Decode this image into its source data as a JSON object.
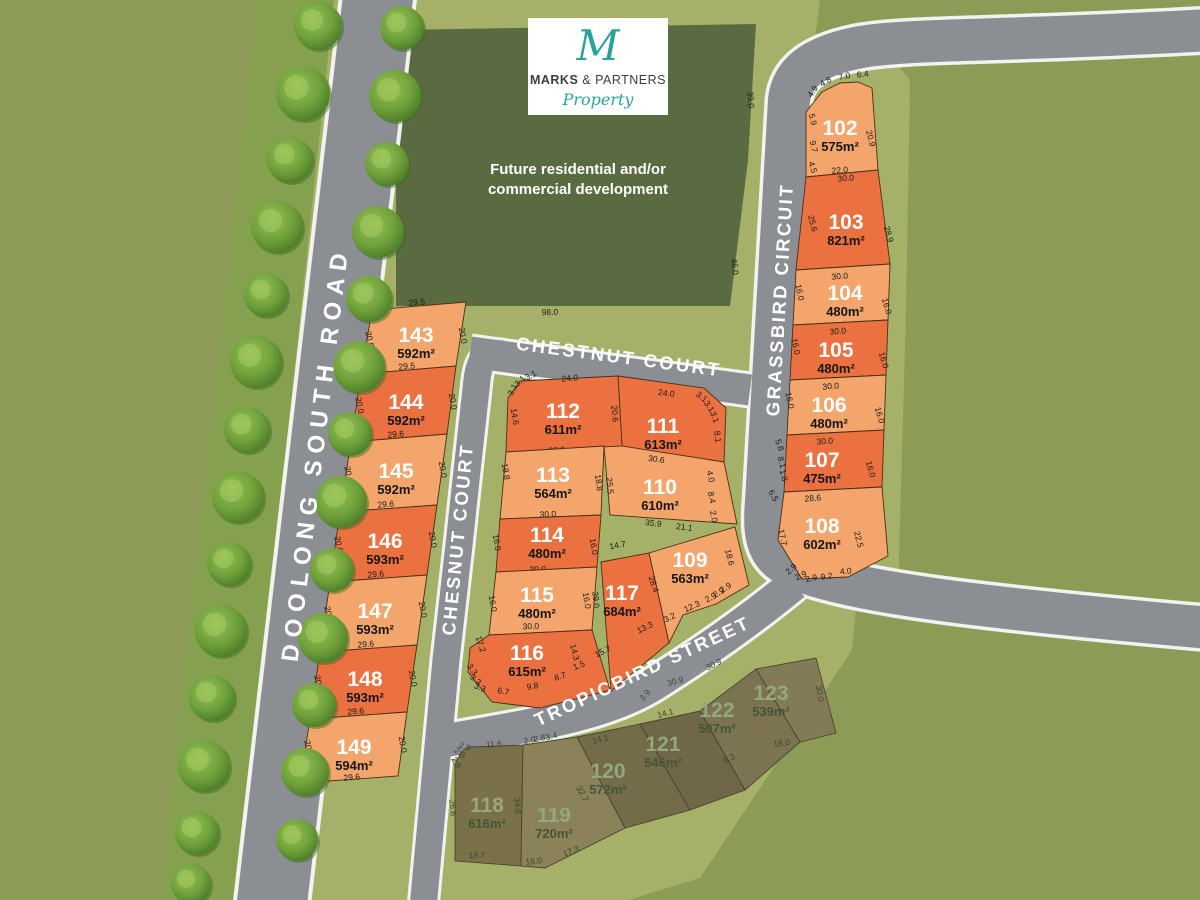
{
  "logo": {
    "initial": "M",
    "name_bold": "MARKS",
    "name_rest": " & PARTNERS",
    "tagline": "Property",
    "teal": "#2BA39B"
  },
  "future_block": {
    "label_line1": "Future residential and/or",
    "label_line2": "commercial development",
    "dims": [
      "75.0",
      "39.0",
      "46.0",
      "98.0"
    ]
  },
  "streets": {
    "doolong": "DOOLONG SOUTH ROAD",
    "chestnut": "CHESTNUT COURT",
    "chesnut": "CHESNUT COURT",
    "grassbird": "GRASSBIRD CIRCUIT",
    "tropicbird": "TROPICBIRD STREET"
  },
  "colors": {
    "lot_available_light": "#F4A56C",
    "lot_available_dark": "#EC7140",
    "lot_sold_base": "#7B7148",
    "road": "#8B8F94",
    "estate_green": "#A5B169",
    "olive_background": "#8C9C57",
    "future_block_green": "#5A6B41"
  },
  "lots": [
    {
      "number": "102",
      "area": "575m²",
      "status": "available",
      "dims": [
        "4.9",
        "4.8",
        "7.0",
        "6.4",
        "5.9",
        "9.7",
        "4.5",
        "20.9",
        "22.0"
      ]
    },
    {
      "number": "103",
      "area": "821m²",
      "status": "available",
      "dims": [
        "30.0",
        "25.6",
        "28.9"
      ]
    },
    {
      "number": "104",
      "area": "480m²",
      "status": "available",
      "dims": [
        "30.0",
        "16.0",
        "16.0"
      ]
    },
    {
      "number": "105",
      "area": "480m²",
      "status": "available",
      "dims": [
        "30.0",
        "16.0",
        "16.0"
      ]
    },
    {
      "number": "106",
      "area": "480m²",
      "status": "available",
      "dims": [
        "30.0",
        "16.0",
        "16.0"
      ]
    },
    {
      "number": "107",
      "area": "475m²",
      "status": "available",
      "dims": [
        "30.0",
        "5.8",
        "8.1",
        "1.8",
        "16.0"
      ]
    },
    {
      "number": "108",
      "area": "602m²",
      "status": "available",
      "dims": [
        "28.6",
        "6.5",
        "17.7",
        "22.5",
        "2.9",
        "2.9",
        "2.9",
        "9.2",
        "4.0"
      ]
    },
    {
      "number": "109",
      "area": "563m²",
      "status": "available",
      "dims": [
        "18.6",
        "12.3",
        "2.9",
        "2.9",
        "2.9"
      ]
    },
    {
      "number": "110",
      "area": "610m²",
      "status": "available",
      "dims": [
        "30.6",
        "25.5",
        "6.4",
        "4.0",
        "8.4",
        "2.0",
        "35.9",
        "21.1"
      ]
    },
    {
      "number": "111",
      "area": "613m²",
      "status": "available",
      "dims": [
        "24.0",
        "3.1",
        "3.1",
        "3.1",
        "8.1"
      ]
    },
    {
      "number": "112",
      "area": "611m²",
      "status": "available",
      "dims": [
        "3.1",
        "3.1",
        "3.1",
        "24.0",
        "14.6",
        "20.6",
        "30.0"
      ]
    },
    {
      "number": "113",
      "area": "564m²",
      "status": "available",
      "dims": [
        "18.8",
        "18.8",
        "30.0"
      ]
    },
    {
      "number": "114",
      "area": "480m²",
      "status": "available",
      "dims": [
        "16.0",
        "16.0",
        "30.0"
      ]
    },
    {
      "number": "115",
      "area": "480m²",
      "status": "available",
      "dims": [
        "16.0",
        "16.0",
        "30.0"
      ]
    },
    {
      "number": "116",
      "area": "615m²",
      "status": "available",
      "dims": [
        "17.2",
        "3.3",
        "3.3",
        "3.3",
        "6.7",
        "9.8",
        "8.7",
        "1.5",
        "14.3"
      ]
    },
    {
      "number": "117",
      "area": "684m²",
      "status": "available",
      "dims": [
        "14.7",
        "39.0",
        "28.4",
        "13.3",
        "15.7",
        "3.2"
      ]
    },
    {
      "number": "118",
      "area": "616m²",
      "status": "sold",
      "dims": [
        "2.8",
        "2.8",
        "2.8",
        "11.6",
        "26.6",
        "34.6",
        "18.7"
      ]
    },
    {
      "number": "119",
      "area": "720m²",
      "status": "sold",
      "dims": [
        "2.0",
        "2.8",
        "3.4",
        "32.7",
        "18.0",
        "17.3"
      ]
    },
    {
      "number": "120",
      "area": "572m²",
      "status": "sold",
      "dims": [
        "14.1",
        "3.9"
      ]
    },
    {
      "number": "121",
      "area": "546m²",
      "status": "sold",
      "dims": [
        "30.9",
        "14.1"
      ]
    },
    {
      "number": "122",
      "area": "507m²",
      "status": "sold",
      "dims": [
        "30.9",
        "6.3"
      ]
    },
    {
      "number": "123",
      "area": "539m²",
      "status": "sold",
      "dims": [
        "30.0",
        "18.0"
      ]
    },
    {
      "number": "143",
      "area": "592m²",
      "status": "available",
      "dims": [
        "29.5",
        "20.0",
        "20.0"
      ]
    },
    {
      "number": "144",
      "area": "592m²",
      "status": "available",
      "dims": [
        "29.5",
        "20.0",
        "20.0"
      ]
    },
    {
      "number": "145",
      "area": "592m²",
      "status": "available",
      "dims": [
        "29.6",
        "20.0",
        "20.0"
      ]
    },
    {
      "number": "146",
      "area": "593m²",
      "status": "available",
      "dims": [
        "29.6",
        "20.0",
        "20.0"
      ]
    },
    {
      "number": "147",
      "area": "593m²",
      "status": "available",
      "dims": [
        "29.6",
        "20.0",
        "20.0"
      ]
    },
    {
      "number": "148",
      "area": "593m²",
      "status": "available",
      "dims": [
        "29.6",
        "20.0",
        "20.0"
      ]
    },
    {
      "number": "149",
      "area": "594m²",
      "status": "available",
      "dims": [
        "29.6",
        "20.0",
        "20.0",
        "29.6"
      ]
    }
  ]
}
